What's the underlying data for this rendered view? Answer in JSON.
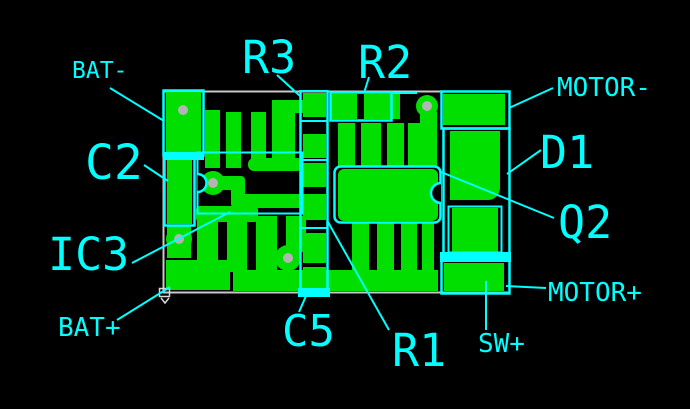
{
  "title": "PCB layout with net and component callouts",
  "colors": {
    "background": "#000000",
    "copper": "#00DF00",
    "silkscreen": "#00FFFF",
    "annotation": "#00FFFF",
    "board_edge": "#C8C8C8",
    "hole": "#B4B4B4",
    "origin_marker": "#D8D8D8"
  },
  "callouts": [
    {
      "id": "bat-minus",
      "text": "BAT-",
      "x": 72,
      "y": 60,
      "size": 23,
      "leader": {
        "x1": 110,
        "y1": 88,
        "x2": 164,
        "y2": 121
      }
    },
    {
      "id": "c2",
      "text": "C2",
      "x": 85,
      "y": 139,
      "size": 48,
      "leader": {
        "x1": 144,
        "y1": 165,
        "x2": 168,
        "y2": 181
      }
    },
    {
      "id": "ic3",
      "text": "IC3",
      "x": 48,
      "y": 232,
      "size": 45,
      "leader": {
        "x1": 132,
        "y1": 263,
        "x2": 230,
        "y2": 212
      }
    },
    {
      "id": "bat-plus",
      "text": "BAT+",
      "x": 58,
      "y": 315,
      "size": 26,
      "leader": {
        "x1": 117,
        "y1": 320,
        "x2": 170,
        "y2": 287
      }
    },
    {
      "id": "r3",
      "text": "R3",
      "x": 242,
      "y": 35,
      "size": 45,
      "leader": {
        "x1": 277,
        "y1": 75,
        "x2": 300,
        "y2": 96
      }
    },
    {
      "id": "r2",
      "text": "R2",
      "x": 358,
      "y": 40,
      "size": 45,
      "leader": {
        "x1": 369,
        "y1": 77,
        "x2": 364,
        "y2": 93
      }
    },
    {
      "id": "motor-minus",
      "text": "MOTOR-",
      "x": 557,
      "y": 75,
      "size": 26,
      "leader": {
        "x1": 553,
        "y1": 88,
        "x2": 509,
        "y2": 108
      }
    },
    {
      "id": "d1",
      "text": "D1",
      "x": 540,
      "y": 130,
      "size": 45,
      "leader": {
        "x1": 541,
        "y1": 150,
        "x2": 507,
        "y2": 174
      }
    },
    {
      "id": "q2",
      "text": "Q2",
      "x": 558,
      "y": 200,
      "size": 45,
      "leader": {
        "x1": 554,
        "y1": 218,
        "x2": 441,
        "y2": 172
      }
    },
    {
      "id": "motor-plus",
      "text": "MOTOR+",
      "x": 548,
      "y": 280,
      "size": 26,
      "leader": {
        "x1": 546,
        "y1": 288,
        "x2": 506,
        "y2": 286
      }
    },
    {
      "id": "sw-plus",
      "text": "SW+",
      "x": 478,
      "y": 331,
      "size": 26,
      "leader": {
        "x1": 486,
        "y1": 330,
        "x2": 486,
        "y2": 281
      }
    },
    {
      "id": "r1",
      "text": "R1",
      "x": 392,
      "y": 328,
      "size": 45,
      "leader": {
        "x1": 389,
        "y1": 330,
        "x2": 328,
        "y2": 222
      }
    },
    {
      "id": "c5",
      "text": "C5",
      "x": 282,
      "y": 310,
      "size": 44,
      "leader": {
        "x1": 299,
        "y1": 312,
        "x2": 306,
        "y2": 296
      }
    }
  ]
}
